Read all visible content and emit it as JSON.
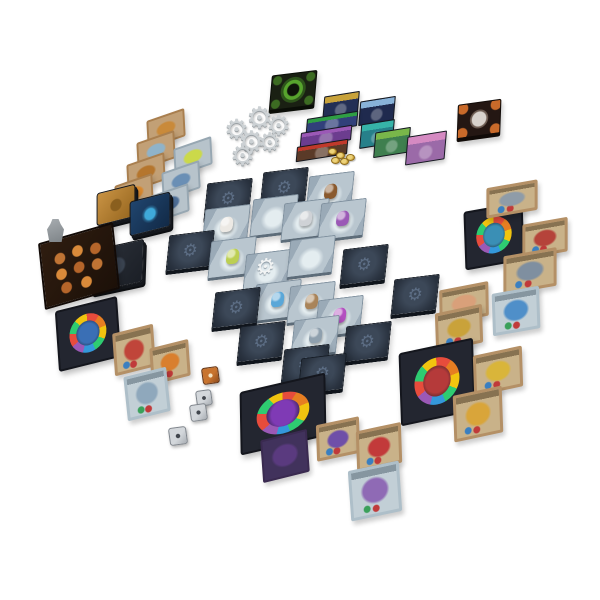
{
  "scene": {
    "description": "Overhead product photo of a fantasy dungeon-crawler board game fully set up on a white background: a central dungeon of square tiles with miniatures, face-down gear-backed tiles, market card rows, gear tokens, card decks, four player boards with colored token tracks, item and monster cards, coins and engraved dice.",
    "background": "#ffffff"
  },
  "dungeon": {
    "label": "Central dungeon grid of square tiles (face-up rooms with miniatures, face-down gear-emblem tiles)",
    "gear_glyph": "⚙",
    "minis": {
      "brown": "#8a5a2e",
      "white": "#ece9e4",
      "silver": "#cfd2d6",
      "purple": "#9b59b6",
      "green": "#bccf52",
      "blue": "#5aa7d8",
      "tan": "#a9845a",
      "magenta": "#b44fc0",
      "slate": "#8fa0ae"
    },
    "tiles": [
      {
        "x": 205,
        "y": 181,
        "f": "d"
      },
      {
        "x": 261,
        "y": 170,
        "f": "d"
      },
      {
        "x": 307,
        "y": 174,
        "f": "u",
        "m": "brown"
      },
      {
        "x": 203,
        "y": 207,
        "f": "u",
        "m": "white"
      },
      {
        "x": 251,
        "y": 197,
        "f": "u",
        "m": ""
      },
      {
        "x": 282,
        "y": 201,
        "f": "u",
        "m": "silver"
      },
      {
        "x": 319,
        "y": 201,
        "f": "u",
        "m": "purple"
      },
      {
        "x": 167,
        "y": 233,
        "f": "d"
      },
      {
        "x": 209,
        "y": 239,
        "f": "u",
        "m": "green"
      },
      {
        "x": 244,
        "y": 252,
        "f": "u",
        "m": "",
        "t": "gear"
      },
      {
        "x": 288,
        "y": 238,
        "f": "u",
        "m": ""
      },
      {
        "x": 341,
        "y": 247,
        "f": "d"
      },
      {
        "x": 392,
        "y": 277,
        "f": "d"
      },
      {
        "x": 254,
        "y": 282,
        "f": "u",
        "m": "blue"
      },
      {
        "x": 288,
        "y": 284,
        "f": "u",
        "m": "tan"
      },
      {
        "x": 316,
        "y": 298,
        "f": "u",
        "m": "magenta"
      },
      {
        "x": 213,
        "y": 290,
        "f": "d"
      },
      {
        "x": 238,
        "y": 324,
        "f": "d"
      },
      {
        "x": 292,
        "y": 318,
        "f": "u",
        "m": "slate"
      },
      {
        "x": 282,
        "y": 347,
        "f": "d"
      },
      {
        "x": 344,
        "y": 324,
        "f": "d"
      },
      {
        "x": 299,
        "y": 356,
        "f": "d"
      }
    ]
  },
  "market": {
    "label": "Market display rows of cards at top",
    "cards": [
      {
        "x": 323,
        "y": 94,
        "w": 36,
        "h": 24,
        "base": "#232f55",
        "band": "#c8a23a"
      },
      {
        "x": 359,
        "y": 99,
        "w": 36,
        "h": 24,
        "base": "#1f2a4e",
        "band": "#88b2d8"
      },
      {
        "x": 306,
        "y": 115,
        "w": 52,
        "h": 15,
        "base": "#31407a",
        "band": "#2f9e44"
      },
      {
        "x": 300,
        "y": 129,
        "w": 52,
        "h": 15,
        "base": "#6c3d8f",
        "band": "#9b59b6"
      },
      {
        "x": 296,
        "y": 143,
        "w": 52,
        "h": 15,
        "base": "#5a3a28",
        "band": "#c0392b"
      },
      {
        "x": 360,
        "y": 122,
        "w": 34,
        "h": 24,
        "base": "#27808a",
        "band": "#36b3a8"
      },
      {
        "x": 374,
        "y": 130,
        "w": 36,
        "h": 25,
        "base": "#3f7f4f",
        "band": "#79b74a"
      },
      {
        "x": 406,
        "y": 134,
        "w": 40,
        "h": 28,
        "base": "#9b6aa8",
        "band": "#d58ac2"
      }
    ],
    "coins": {
      "label": "pile of gold coins",
      "positions": [
        [
          328,
          148
        ],
        [
          336,
          152
        ],
        [
          331,
          157
        ],
        [
          340,
          158
        ],
        [
          346,
          154
        ]
      ]
    }
  },
  "gears": {
    "label": "Cluster of grey gear tokens",
    "glyph": "⚙",
    "items": [
      [
        246,
        104,
        30
      ],
      [
        224,
        116,
        28
      ],
      [
        266,
        112,
        28
      ],
      [
        238,
        128,
        30
      ],
      [
        258,
        130,
        26
      ],
      [
        230,
        142,
        28
      ]
    ]
  },
  "strips": {
    "label": "Two fanned columns of cards on the left",
    "tan": {
      "base": "#a97f4f",
      "cards": [
        {
          "x": 146,
          "y": 115,
          "art": "#c98a3a"
        },
        {
          "x": 136,
          "y": 137,
          "art": "#8fb3c9"
        },
        {
          "x": 126,
          "y": 159,
          "art": "#b5762e"
        },
        {
          "x": 114,
          "y": 180,
          "art": "#d9892e"
        }
      ]
    },
    "grey": {
      "base": "#97a7b2",
      "cards": [
        {
          "x": 173,
          "y": 143,
          "art": "#cbd94a"
        },
        {
          "x": 161,
          "y": 167,
          "art": "#6a8fb5"
        },
        {
          "x": 150,
          "y": 190,
          "art": "#51729b"
        }
      ]
    }
  },
  "dice": {
    "label": "One bronze and three silver engraved dice",
    "items": [
      {
        "x": 202,
        "y": 367,
        "s": 17,
        "kind": "orange"
      },
      {
        "x": 196,
        "y": 390,
        "s": 16,
        "kind": "silver"
      },
      {
        "x": 190,
        "y": 404,
        "s": 17,
        "kind": "silver"
      },
      {
        "x": 169,
        "y": 427,
        "s": 18,
        "kind": "silver"
      }
    ]
  },
  "components": {
    "entrance_tile": {
      "label": "Dark tile with glowing green gear emblem",
      "art": "#57a32d"
    },
    "boss_tile": {
      "label": "Dark tile with orange corners and pale emblem",
      "art": "#d8d2cc"
    },
    "gold_deck": {
      "label": "Gold-backed card deck",
      "art": "#b07c2f"
    },
    "blue_deck": {
      "label": "Blue-backed card deck with glowing emblem",
      "art": "#3fa9d9"
    },
    "dark_deck": {
      "label": "Dark slate card deck",
      "art": "#3a4350"
    },
    "supply_board": {
      "label": "Dark supply board covered with copper tokens"
    },
    "grey_mini": {
      "label": "Small grey miniature figure"
    },
    "right_board": {
      "label": "Hero board with colored token track (right)",
      "glow": "#3a8fb5"
    },
    "red_board": {
      "label": "Hero board with colored token track (red demon)",
      "glow": "#b53a3a"
    },
    "blue_board": {
      "label": "Hero board with colored token track (blue, lower left)",
      "glow": "#3a6fb5"
    },
    "purple_board": {
      "label": "Hero board with colored token track (purple demon)",
      "glow": "#7f3ab5"
    },
    "right_card_top": {
      "label": "Tan item card",
      "art": "#8f9ca8"
    },
    "right_card_mid": {
      "label": "Tan item card with red item",
      "art": "#b5433a"
    },
    "right_card_bot": {
      "label": "Tan item card with grey item",
      "art": "#7f8fa0"
    },
    "portrait_card": {
      "label": "Hero portrait card",
      "art": "#d9a07a"
    },
    "blue_spell": {
      "label": "Pale card with blue figure",
      "art": "#4f8fc9"
    },
    "tan_mid": {
      "label": "Tan item card with golden item",
      "art": "#c9a23a"
    },
    "tan_gauntlet": {
      "label": "Tan item card with golden gauntlet",
      "art": "#d9b53a"
    },
    "tan_hammer": {
      "label": "Tan item card with golden hammer",
      "art": "#d9a53a"
    },
    "tan_red": {
      "label": "Tan monster card with red creature",
      "art": "#c0453a"
    },
    "tan_ring": {
      "label": "Tan item card with orange ring",
      "art": "#d97f2e"
    },
    "spell_left": {
      "label": "Pale spell card with reward chips",
      "art": "#8fa8bc"
    },
    "tan_bat": {
      "label": "Tan monster card with purple bat",
      "art": "#6f4fa8"
    },
    "tan_red2": {
      "label": "Tan monster card with red creature",
      "art": "#c23a3a"
    },
    "purple_card": {
      "label": "Dark purple creature card",
      "art": "#5a3a7f"
    },
    "dragon_card": {
      "label": "Pale card with purple dragon",
      "art": "#8f6ab5"
    }
  }
}
